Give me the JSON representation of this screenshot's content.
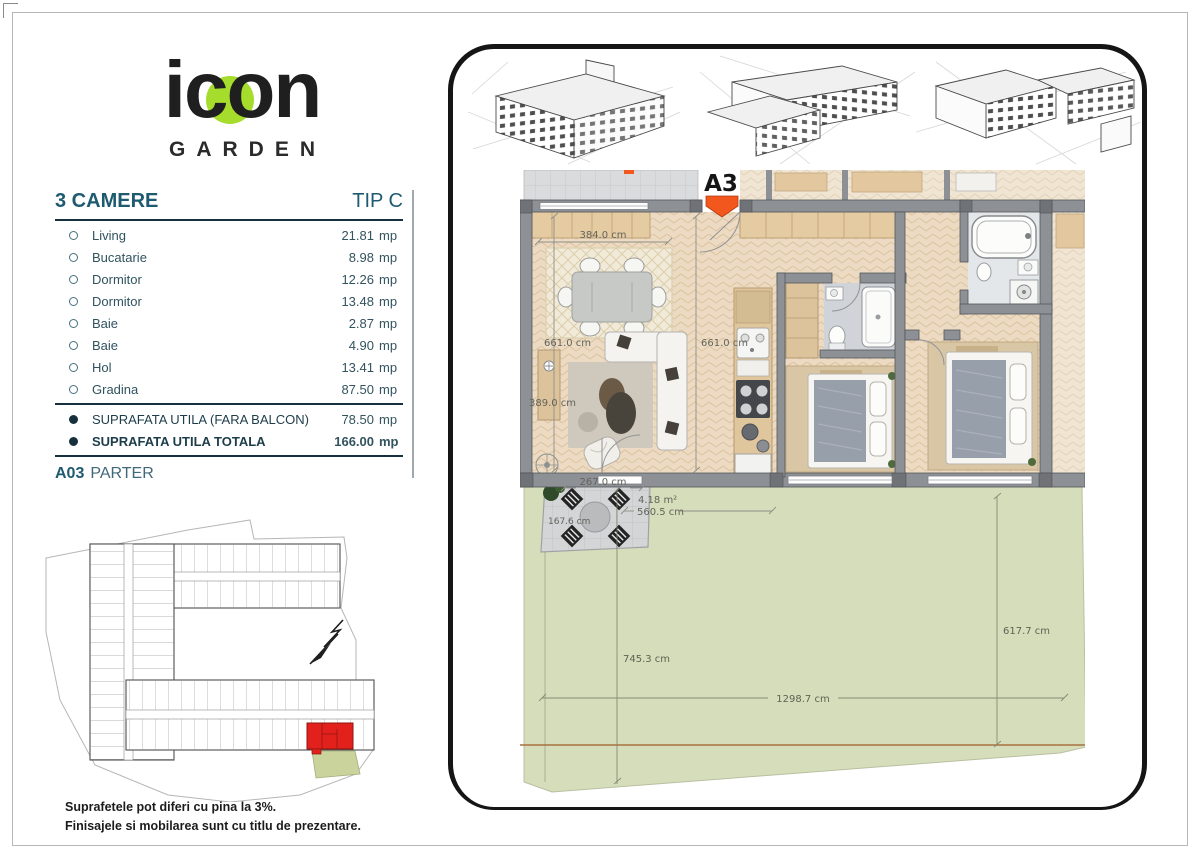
{
  "brand": {
    "name": "icon",
    "tagline": "GARDEN"
  },
  "colors": {
    "brand_green": "#a6dd2c",
    "title_teal": "#1e5a70",
    "marker_orange": "#f2571e",
    "site_highlight_red": "#e2211c",
    "site_garden_green": "#c9d39b",
    "plan_garden_green": "#d6ddba",
    "plan_floor_beige": "#ecdbc2",
    "plan_wall_gray": "#8d9196"
  },
  "spec": {
    "title": "3 CAMERE",
    "type_label": "TIP C",
    "area_unit": "mp",
    "rooms": [
      {
        "label": "Living",
        "area": "21.81"
      },
      {
        "label": "Bucatarie",
        "area": "8.98"
      },
      {
        "label": "Dormitor",
        "area": "12.26"
      },
      {
        "label": "Dormitor",
        "area": "13.48"
      },
      {
        "label": "Baie",
        "area": "2.87"
      },
      {
        "label": "Baie",
        "area": "4.90"
      },
      {
        "label": "Hol",
        "area": "13.41"
      },
      {
        "label": "Gradina",
        "area": "87.50"
      }
    ],
    "totals": [
      {
        "label": "SUPRAFATA UTILA (FARA BALCON)",
        "area": "78.50"
      },
      {
        "label": "SUPRAFATA UTILA TOTALA",
        "area": "166.00"
      }
    ],
    "unit_code": "A03",
    "unit_level": "PARTER"
  },
  "plan": {
    "marker": "A3",
    "dims": {
      "dining_width": "384.0 cm",
      "living_height": "661.0 cm",
      "hall_height": "661.0 cm",
      "living_width": "389.0 cm",
      "terrace_width": "267.0 cm",
      "terrace_area": "4.18 m²",
      "terrace_span": "560.5 cm",
      "terrace_depth": "167.6 cm",
      "garden_depth_left": "745.3 cm",
      "garden_depth_right": "617.7 cm",
      "garden_width": "1298.7 cm"
    }
  },
  "disclaimer": {
    "line1": "Suprafetele pot diferi cu pina la 3%.",
    "line2": "Finisajele si mobilarea sunt cu titlu de prezentare."
  }
}
